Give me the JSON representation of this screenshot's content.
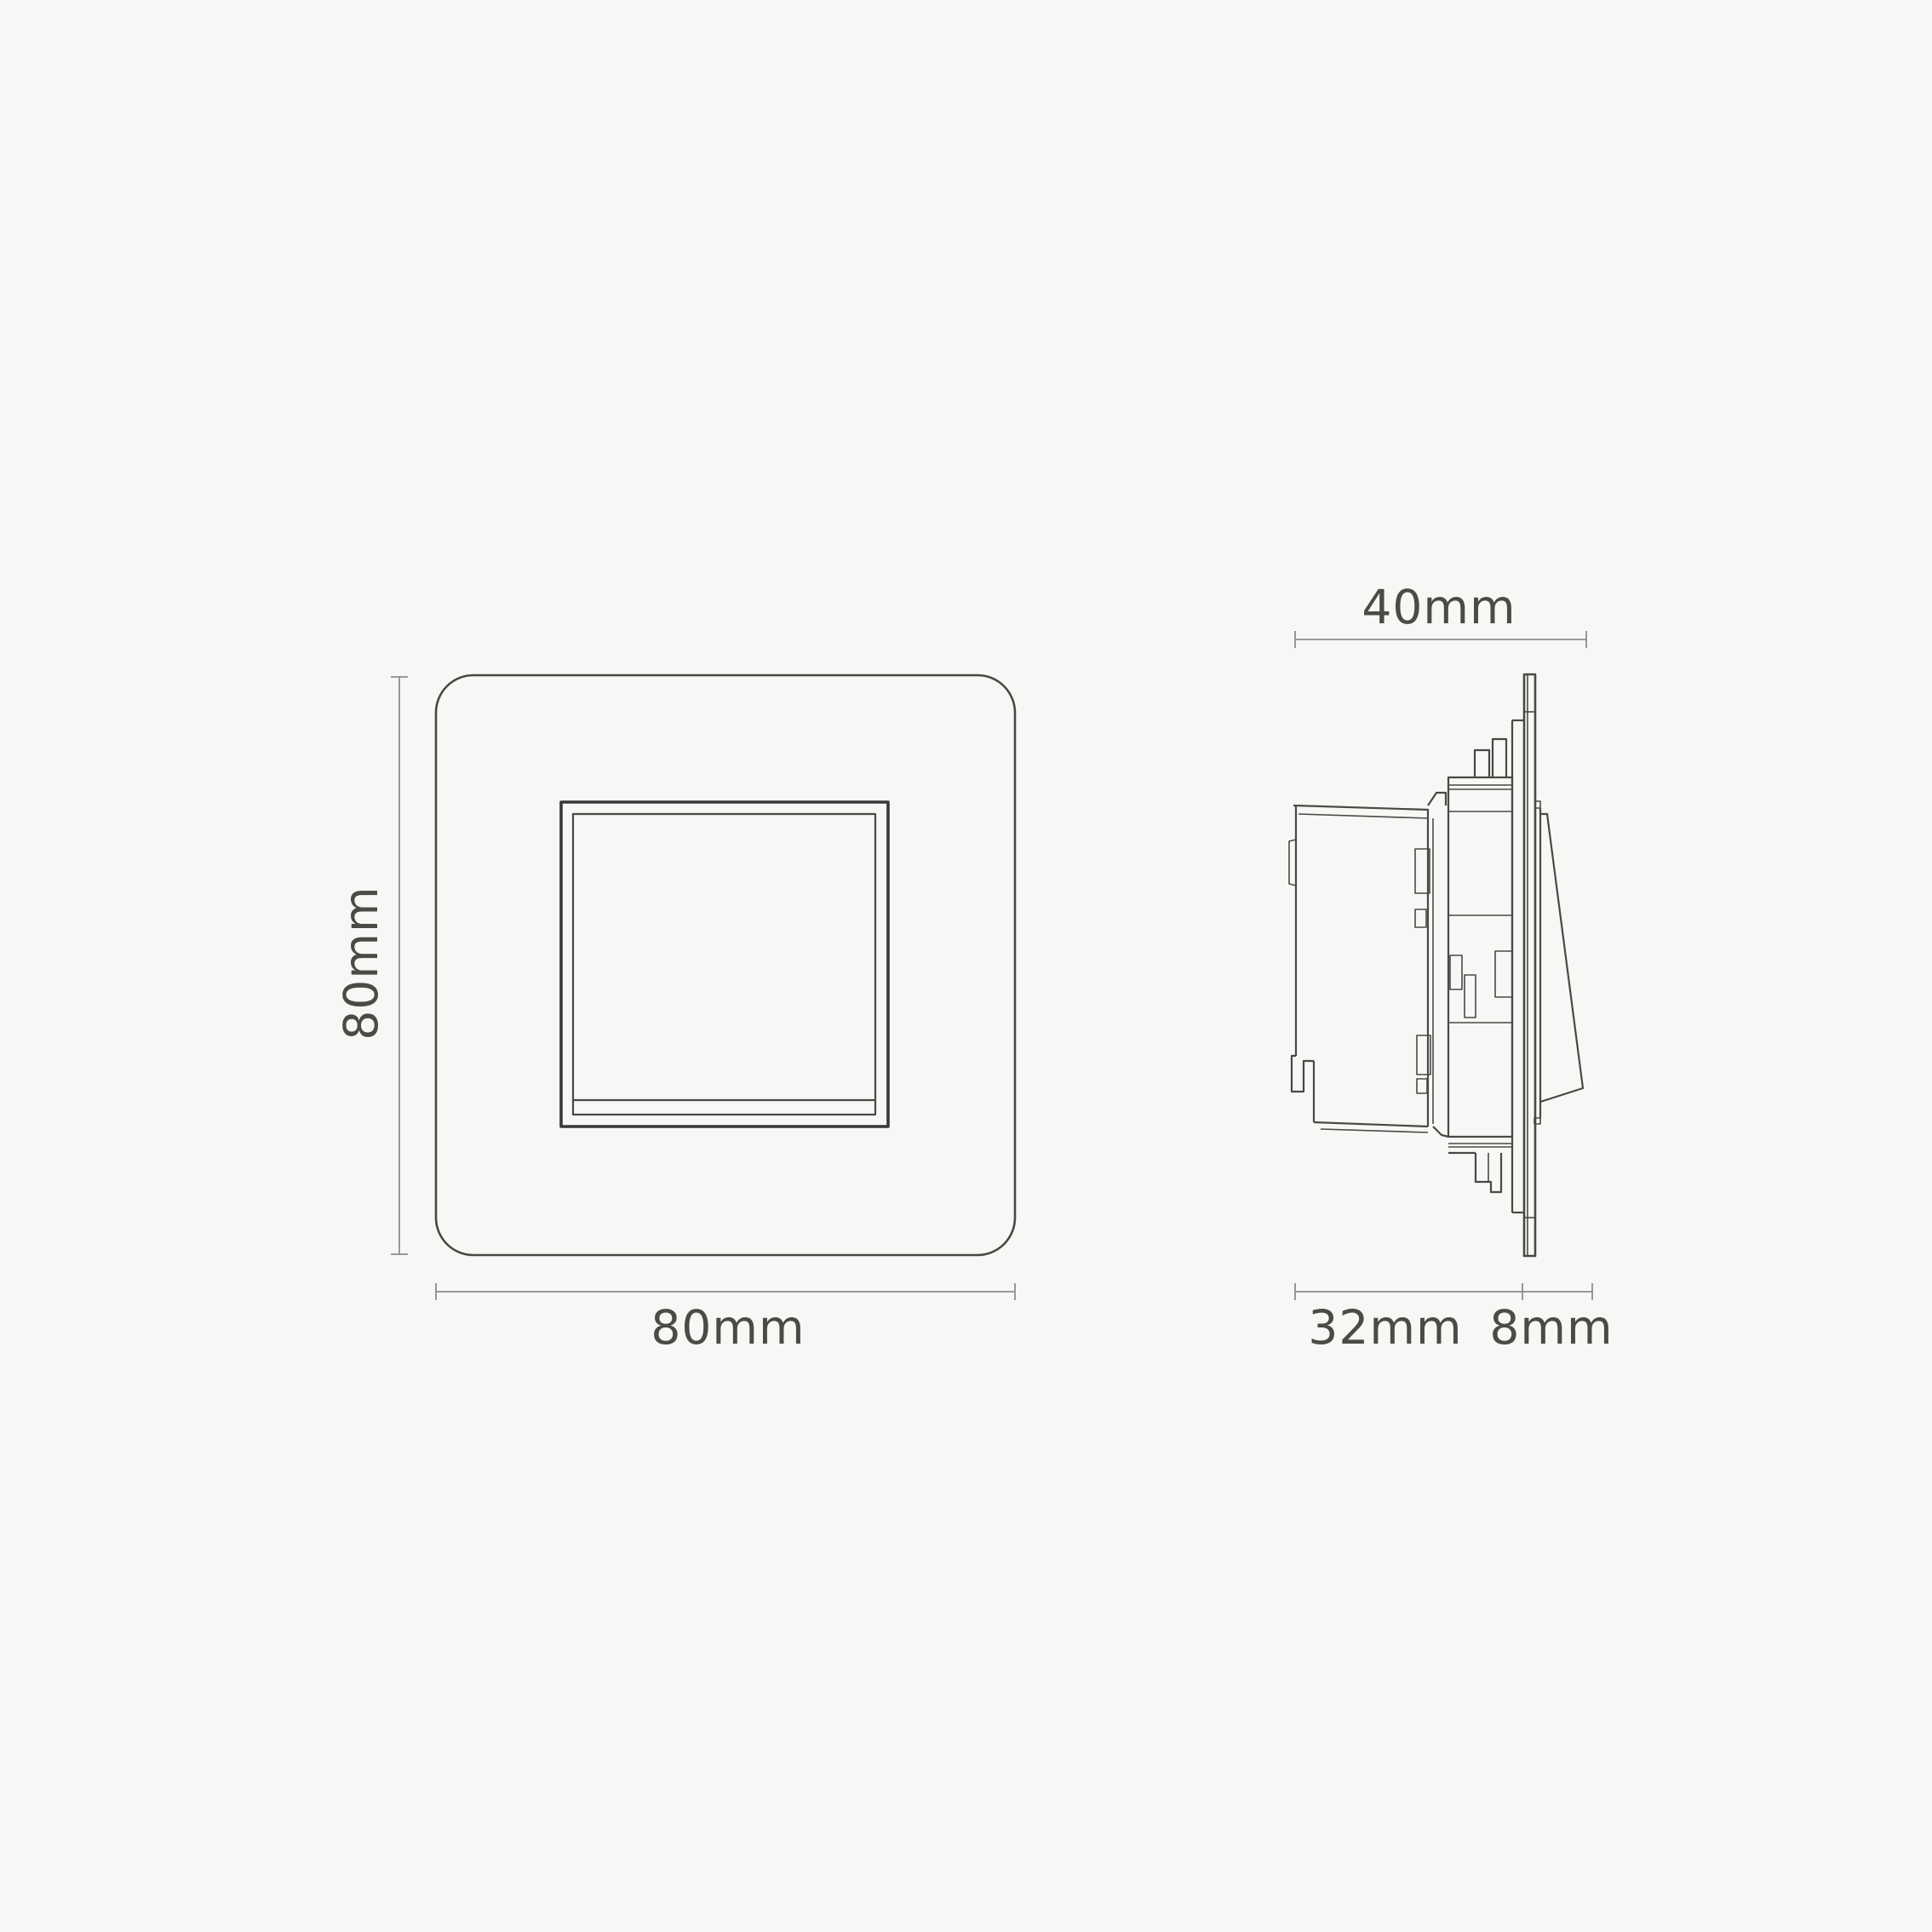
{
  "diagram": {
    "description": "Dimension drawing of a single rocker wall switch, front elevation and side profile",
    "front_view": {
      "height_label": "80mm",
      "width_label": "80mm"
    },
    "side_view": {
      "depth_label": "40mm",
      "recess_label": "32mm",
      "protrusion_label": "8mm"
    }
  },
  "colors": {
    "background": "#f7f7f6",
    "line": "#4a4845",
    "frame": "#3a3836",
    "dim_line": "#8d8d8d",
    "text": "#4c4a47"
  }
}
